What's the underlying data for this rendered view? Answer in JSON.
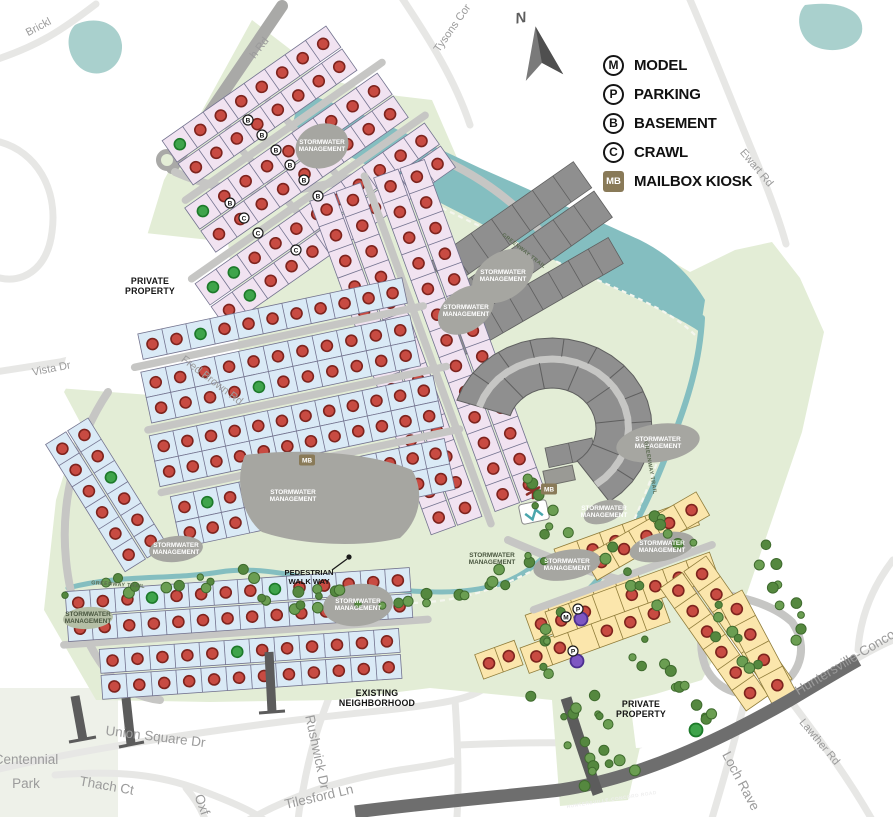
{
  "colors": {
    "site_green": "#e3edd6",
    "park_green": "#eef1e9",
    "river": "#84bec0",
    "pond_teal": "#a9d0cd",
    "road_light": "#e7e7e5",
    "road_internal": "#c6c6c4",
    "road_entry": "#a9a9a7",
    "road_dark": "#6e6e6e",
    "road_stub": "#5c5c5c",
    "lot_lavender": "#f1e3f1",
    "lot_blue": "#daeaf6",
    "lot_yellow": "#fbe6ac",
    "lot_gray": "#8f8f8f",
    "lot_stroke": "#73738f",
    "lot_stroke_yellow": "#8f7c3a",
    "lot_stroke_gray": "#5f5f5f",
    "pond_gray": "#a6a6a1",
    "dot_red": "#c84b42",
    "dot_red_ring": "#7e241e",
    "dot_green": "#3fa44b",
    "dot_green_ring": "#1d7a2a",
    "dot_purple": "#7e57c2",
    "dot_purple_ring": "#4b2f8f",
    "tree": "#6b9e52",
    "tree_dark": "#55883f",
    "badge_mb": "#897a58",
    "arrow": "#6b6b6b"
  },
  "legend": {
    "items": [
      {
        "symbol": "M",
        "label": "MODEL",
        "shape": "circle"
      },
      {
        "symbol": "P",
        "label": "PARKING",
        "shape": "circle"
      },
      {
        "symbol": "B",
        "label": "BASEMENT",
        "shape": "circle"
      },
      {
        "symbol": "C",
        "label": "CRAWL",
        "shape": "circle"
      },
      {
        "symbol": "MB",
        "label": "MAILBOX KIOSK",
        "shape": "square"
      }
    ]
  },
  "north": {
    "label": "N"
  },
  "map": {
    "labels": [
      {
        "t": "Brickl",
        "x": 40,
        "y": 30,
        "r": -28,
        "c": "street"
      },
      {
        "t": "h Rd",
        "x": 262,
        "y": 50,
        "r": -52,
        "c": "street"
      },
      {
        "t": "Tysons Cor",
        "x": 455,
        "y": 30,
        "r": -55,
        "c": "street"
      },
      {
        "t": "Ewart Rd",
        "x": 754,
        "y": 170,
        "r": 50,
        "c": "street"
      },
      {
        "t": "Vista Dr",
        "x": 52,
        "y": 372,
        "r": -11,
        "c": "street"
      },
      {
        "t": "Fred Brown Rd",
        "x": 210,
        "y": 383,
        "r": 37,
        "c": "street"
      },
      {
        "t": "Union Square Dr",
        "x": 155,
        "y": 741,
        "r": 7,
        "c": "street-lg"
      },
      {
        "t": "Thach Ct",
        "x": 106,
        "y": 790,
        "r": 10,
        "c": "street-lg"
      },
      {
        "t": "Oxf",
        "x": 198,
        "y": 806,
        "r": 70,
        "c": "street-lg"
      },
      {
        "t": "Rushwick Dr",
        "x": 313,
        "y": 753,
        "r": 78,
        "c": "street-lg"
      },
      {
        "t": "Tilesford Ln",
        "x": 320,
        "y": 801,
        "r": -13,
        "c": "street-lg"
      },
      {
        "t": "Loch Rave",
        "x": 737,
        "y": 783,
        "r": 62,
        "c": "street-lg"
      },
      {
        "t": "Lawther Rd",
        "x": 817,
        "y": 744,
        "r": 50,
        "c": "street"
      },
      {
        "t": "Huntersville-Concor",
        "x": 849,
        "y": 665,
        "r": -31,
        "c": "street-lg"
      },
      {
        "lines": [
          "Centennial",
          "Park"
        ],
        "x": 26,
        "y": 764,
        "lh": 24,
        "c": "street-lg"
      },
      {
        "t": "HUNTERSVILLE-CONCORD ROAD",
        "x": 612,
        "y": 801,
        "r": -9,
        "c": "road-white"
      },
      {
        "lines": [
          "PRIVATE",
          "PROPERTY"
        ],
        "x": 150,
        "y": 284,
        "lh": 10,
        "c": "bold"
      },
      {
        "lines": [
          "PRIVATE",
          "PROPERTY"
        ],
        "x": 641,
        "y": 707,
        "lh": 10,
        "c": "bold"
      },
      {
        "lines": [
          "EXISTING",
          "NEIGHBORHOOD"
        ],
        "x": 377,
        "y": 696,
        "lh": 10,
        "c": "bold"
      },
      {
        "lines": [
          "PEDESTRIAN",
          "WALK WAY"
        ],
        "x": 309,
        "y": 575,
        "lh": 9,
        "c": "bold-sm"
      },
      {
        "lines": [
          "STORMWATER",
          "MANAGEMENT"
        ],
        "x": 322,
        "y": 144,
        "lh": 7,
        "c": "pond"
      },
      {
        "lines": [
          "STORMWATER",
          "MANAGEMENT"
        ],
        "x": 503,
        "y": 274,
        "lh": 7,
        "c": "pond"
      },
      {
        "lines": [
          "STORMWATER",
          "MANAGEMENT"
        ],
        "x": 466,
        "y": 309,
        "lh": 7,
        "c": "pond"
      },
      {
        "lines": [
          "STORMWATER",
          "MANAGEMENT"
        ],
        "x": 293,
        "y": 494,
        "lh": 7,
        "c": "pond"
      },
      {
        "lines": [
          "STORMWATER",
          "MANAGEMENT"
        ],
        "x": 658,
        "y": 441,
        "lh": 7,
        "c": "pond"
      },
      {
        "lines": [
          "STORMWATER",
          "MANAGEMENT"
        ],
        "x": 176,
        "y": 547,
        "lh": 7,
        "c": "pond"
      },
      {
        "lines": [
          "STORMWATER",
          "MANAGEMENT"
        ],
        "x": 358,
        "y": 603,
        "lh": 7,
        "c": "pond"
      },
      {
        "lines": [
          "STORMWATER",
          "MANAGEMENT"
        ],
        "x": 604,
        "y": 510,
        "lh": 7,
        "c": "pond"
      },
      {
        "lines": [
          "STORMWATER",
          "MANAGEMENT"
        ],
        "x": 567,
        "y": 563,
        "lh": 7,
        "c": "pond"
      },
      {
        "lines": [
          "STORMWATER",
          "MANAGEMENT"
        ],
        "x": 662,
        "y": 545,
        "lh": 7,
        "c": "pond"
      },
      {
        "lines": [
          "STORMWATER",
          "MANAGEMENT"
        ],
        "x": 88,
        "y": 616,
        "lh": 7,
        "c": "pond-dark"
      },
      {
        "lines": [
          "STORMWATER",
          "MANAGEMENT"
        ],
        "x": 492,
        "y": 557,
        "lh": 7,
        "c": "pond-dark"
      },
      {
        "t": "GREENWAY TRAIL",
        "x": 523,
        "y": 252,
        "r": 38,
        "c": "trail"
      },
      {
        "t": "GREENWAY TRAIL",
        "x": 649,
        "y": 468,
        "r": 80,
        "c": "trail"
      },
      {
        "t": "GREENWAY TRAIL",
        "x": 118,
        "y": 586,
        "r": 4,
        "c": "trail"
      }
    ],
    "clusters": [
      {
        "name": "gray-rows-north",
        "tx": 430,
        "ty": 262,
        "rot": -35,
        "f": "gray",
        "d": 32,
        "strips": [
          {
            "x": 0,
            "y": 0,
            "l": 175,
            "n": 7,
            "dots": ""
          },
          {
            "x": 0,
            "y": 36,
            "l": 175,
            "n": 7,
            "dots": ""
          }
        ]
      },
      {
        "name": "gray-rows-mid",
        "tx": 448,
        "ty": 330,
        "rot": -30,
        "f": "gray",
        "d": 30,
        "strips": [
          {
            "x": 0,
            "y": 0,
            "l": 185,
            "n": 8,
            "dots": ""
          }
        ]
      },
      {
        "name": "gray-rows-amenity",
        "tx": 545,
        "ty": 448,
        "rot": -12,
        "f": "gray",
        "d": 20,
        "strips": [
          {
            "x": 0,
            "y": 0,
            "l": 48,
            "n": 2,
            "dots": ""
          }
        ]
      },
      {
        "name": "north-lavender",
        "tx": 210,
        "ty": 305,
        "rot": -35,
        "f": "lav",
        "d": 26,
        "roads": [
          {
            "x": 40,
            "y": -100,
            "l": 240
          },
          {
            "x": 0,
            "y": -32,
            "l": 285
          }
        ],
        "strips": [
          {
            "x": 55,
            "y": -162,
            "l": 200,
            "n": 8,
            "dots": "grrrrrrr"
          },
          {
            "x": 55,
            "y": -134,
            "l": 200,
            "n": 8
          },
          {
            "x": 35,
            "y": -94,
            "l": 235,
            "n": 9,
            "dots": "grrrrrrrr"
          },
          {
            "x": 35,
            "y": -66,
            "l": 235,
            "n": 9
          },
          {
            "x": 0,
            "y": -26,
            "l": 280,
            "n": 11,
            "dots": "ggrrrrrrrrr"
          },
          {
            "x": 0,
            "y": 2,
            "l": 280,
            "n": 11,
            "dots": "rgrrrrrrrrr"
          }
        ]
      },
      {
        "name": "central-spine-pink",
        "tx": 368,
        "ty": 180,
        "rot": 70,
        "f": "lav",
        "d": 26,
        "roads": [
          {
            "x": -5,
            "y": 2,
            "l": 370
          }
        ],
        "strips": [
          {
            "x": 0,
            "y": -60,
            "l": 355,
            "n": 13
          },
          {
            "x": 0,
            "y": -32,
            "l": 355,
            "n": 13
          },
          {
            "x": 0,
            "y": 8,
            "l": 355,
            "n": 13
          },
          {
            "x": 0,
            "y": 36,
            "l": 355,
            "n": 13
          }
        ]
      },
      {
        "name": "west-blue",
        "tx": 128,
        "ty": 336,
        "rot": -12,
        "f": "blue",
        "d": 26,
        "roads": [
          {
            "x": 0,
            "y": 32,
            "l": 295
          },
          {
            "x": 0,
            "y": 96,
            "l": 305
          },
          {
            "x": 0,
            "y": 160,
            "l": 305
          }
        ],
        "strips": [
          {
            "x": 10,
            "y": 0,
            "l": 270,
            "n": 11,
            "dots": "rrgrrrrrrrr"
          },
          {
            "x": 5,
            "y": 38,
            "l": 275,
            "n": 11
          },
          {
            "x": 5,
            "y": 64,
            "l": 275,
            "n": 11,
            "dots": "rrrrgrrrrrr"
          },
          {
            "x": 0,
            "y": 102,
            "l": 290,
            "n": 12
          },
          {
            "x": 0,
            "y": 128,
            "l": 290,
            "n": 12
          },
          {
            "x": 8,
            "y": 166,
            "l": 280,
            "n": 12,
            "dots": "rgrrrrrrrrrr"
          },
          {
            "x": 8,
            "y": 192,
            "l": 280,
            "n": 12
          }
        ]
      },
      {
        "name": "west-loop-blue",
        "tx": 88,
        "ty": 418,
        "rot": 58,
        "f": "blue",
        "d": 24,
        "strips": [
          {
            "x": 0,
            "y": 0,
            "l": 150,
            "n": 6,
            "dots": "rrgrrr"
          },
          {
            "x": 0,
            "y": 26,
            "l": 150,
            "n": 6
          }
        ]
      },
      {
        "name": "south-band-blue",
        "tx": 60,
        "ty": 590,
        "rot": -4,
        "f": "blue",
        "d": 24,
        "roads": [
          {
            "x": 0,
            "y": 55,
            "l": 365
          }
        ],
        "strips": [
          {
            "x": 5,
            "y": 2,
            "l": 345,
            "n": 14,
            "dots": "rrrgrrrrgrrrrr"
          },
          {
            "x": 5,
            "y": 28,
            "l": 345,
            "n": 14
          },
          {
            "x": 35,
            "y": 62,
            "l": 300,
            "n": 12,
            "dots": "rrrrrgrrrrrr"
          },
          {
            "x": 35,
            "y": 88,
            "l": 300,
            "n": 12
          }
        ]
      },
      {
        "name": "yellow-row-a",
        "tx": 520,
        "ty": 648,
        "rot": -20,
        "f": "yel",
        "d": 27,
        "strips": [
          {
            "x": 0,
            "y": 0,
            "l": 150,
            "n": 6,
            "dots": "rr.rrr"
          },
          {
            "x": 16,
            "y": -29,
            "l": 120,
            "n": 5
          }
        ]
      },
      {
        "name": "yellow-row-b",
        "tx": 545,
        "ty": 612,
        "rot": -20,
        "f": "yel",
        "d": 27,
        "roads": [
          {
            "x": -10,
            "y": -6,
            "l": 190
          }
        ],
        "strips": [
          {
            "x": 0,
            "y": 0,
            "l": 175,
            "n": 7,
            "dots": "rr.rrrr"
          },
          {
            "x": 30,
            "y": -56,
            "l": 145,
            "n": 6
          }
        ]
      },
      {
        "name": "yellow-arc-top",
        "tx": 598,
        "ty": 582,
        "rot": -30,
        "f": "yel",
        "d": 27,
        "strips": [
          {
            "x": 0,
            "y": -29,
            "l": 130,
            "n": 5
          }
        ]
      },
      {
        "name": "yellow-fan-east",
        "tx": 706,
        "ty": 556,
        "rot": 55,
        "f": "yel",
        "d": 27,
        "strips": [
          {
            "x": 0,
            "y": 0,
            "l": 150,
            "n": 6
          },
          {
            "x": 0,
            "y": 29,
            "l": 150,
            "n": 6
          }
        ]
      },
      {
        "name": "yellow-fan-outer",
        "tx": 742,
        "ty": 590,
        "rot": 62,
        "f": "yel",
        "d": 27,
        "strips": [
          {
            "x": 0,
            "y": 0,
            "l": 115,
            "n": 4
          }
        ]
      },
      {
        "name": "yellow-pair-west",
        "tx": 514,
        "ty": 634,
        "rot": -20,
        "f": "yel",
        "d": 26,
        "strips": [
          {
            "x": -44,
            "y": 6,
            "l": 42,
            "n": 2
          }
        ]
      }
    ],
    "crescent": {
      "cx": 552,
      "cy": 428,
      "rx1": 44,
      "ry1": 40,
      "rx2": 100,
      "ry2": 90,
      "a1": 198,
      "a2": 415,
      "nOut": 11,
      "nIn": 7
    },
    "trees": [
      {
        "x1": 78,
        "y1": 588,
        "x2": 250,
        "y2": 576,
        "n": 12
      },
      {
        "x1": 258,
        "y1": 592,
        "x2": 470,
        "y2": 602,
        "n": 14
      },
      {
        "x1": 478,
        "y1": 592,
        "x2": 540,
        "y2": 560,
        "n": 7
      },
      {
        "x1": 528,
        "y1": 478,
        "x2": 556,
        "y2": 538,
        "n": 8
      },
      {
        "x1": 548,
        "y1": 610,
        "x2": 536,
        "y2": 688,
        "n": 7
      },
      {
        "x1": 568,
        "y1": 706,
        "x2": 596,
        "y2": 788,
        "n": 9
      },
      {
        "x1": 592,
        "y1": 700,
        "x2": 622,
        "y2": 775,
        "n": 8
      },
      {
        "x1": 638,
        "y1": 648,
        "x2": 706,
        "y2": 722,
        "n": 12
      },
      {
        "x1": 712,
        "y1": 612,
        "x2": 760,
        "y2": 672,
        "n": 8
      },
      {
        "x1": 756,
        "y1": 548,
        "x2": 800,
        "y2": 636,
        "n": 10
      },
      {
        "x1": 608,
        "y1": 556,
        "x2": 656,
        "y2": 596,
        "n": 6
      },
      {
        "x1": 648,
        "y1": 512,
        "x2": 696,
        "y2": 548,
        "n": 6
      },
      {
        "x1": 270,
        "y1": 598,
        "x2": 330,
        "y2": 606,
        "n": 5
      }
    ],
    "badges": [
      {
        "x": 248,
        "y": 120,
        "t": "B"
      },
      {
        "x": 262,
        "y": 135,
        "t": "B"
      },
      {
        "x": 276,
        "y": 150,
        "t": "B"
      },
      {
        "x": 290,
        "y": 165,
        "t": "B"
      },
      {
        "x": 304,
        "y": 180,
        "t": "B"
      },
      {
        "x": 318,
        "y": 196,
        "t": "B"
      },
      {
        "x": 230,
        "y": 203,
        "t": "B"
      },
      {
        "x": 244,
        "y": 218,
        "t": "C"
      },
      {
        "x": 258,
        "y": 233,
        "t": "C"
      },
      {
        "x": 296,
        "y": 250,
        "t": "C"
      },
      {
        "x": 566,
        "y": 617,
        "t": "M"
      },
      {
        "x": 578,
        "y": 609,
        "t": "P"
      },
      {
        "x": 573,
        "y": 651,
        "t": "P"
      }
    ],
    "mb_badges": [
      {
        "x": 307,
        "y": 460
      },
      {
        "x": 549,
        "y": 489
      }
    ],
    "special_dots": [
      {
        "x": 581,
        "y": 619,
        "c": "p"
      },
      {
        "x": 577,
        "y": 661,
        "c": "p"
      },
      {
        "x": 696,
        "y": 730,
        "c": "g"
      }
    ]
  }
}
